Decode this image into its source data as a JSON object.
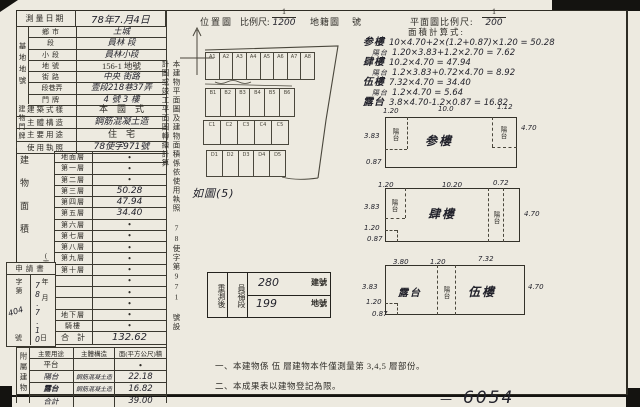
{
  "header": {
    "survey_date_label": "測量日期",
    "survey_date_value": "78年7.月4日",
    "location_map_label": "位置圖",
    "scale_label": "比例尺:",
    "scale_num": "1",
    "scale_den": "1200",
    "cadastral_map_label": "地籍圖",
    "sheet_no_label": "號",
    "plan_scale_label": "平面圖比例尺:",
    "plan_scale_num": "1",
    "plan_scale_den": "200"
  },
  "site": {
    "spine": "基地地號",
    "rows": [
      {
        "label": "鄉市",
        "value": "土城",
        "hw": true
      },
      {
        "label": "段",
        "value": "員林 段",
        "hw": true
      },
      {
        "label": "小段",
        "value": "員林小段",
        "hw": true
      },
      {
        "label": "地號",
        "value": "156-1 地號",
        "hw": false
      }
    ],
    "door_spine": "建物門牌",
    "door_rows": [
      {
        "label": "街路",
        "value": "中央 街路",
        "hw": true
      },
      {
        "label": "段巷弄",
        "value": "壹段218巷37弄",
        "hw": true
      },
      {
        "label": "門牌",
        "value": "4 號 3 樓",
        "hw": true
      }
    ]
  },
  "building": {
    "style_label": "建築式樣",
    "style_value": "本　國　式",
    "structure_label": "主體構造",
    "structure_value": "鋼筋混凝土造",
    "use_label": "主要用途",
    "use_value": "住　宅",
    "license_label": "使用執照",
    "license_value": "78使字971號"
  },
  "area_table": {
    "spine": "建物面積",
    "spine_unit": "(平方公尺)",
    "rows": [
      {
        "label": "地面層",
        "value": "•"
      },
      {
        "label": "第一層",
        "value": "•"
      },
      {
        "label": "第二層",
        "value": "•"
      },
      {
        "label": "第三層",
        "value": "50.28"
      },
      {
        "label": "第四層",
        "value": "47.94"
      },
      {
        "label": "第五層",
        "value": "34.40"
      },
      {
        "label": "第六層",
        "value": "•"
      },
      {
        "label": "第七層",
        "value": "•"
      },
      {
        "label": "第八層",
        "value": "•"
      },
      {
        "label": "第九層",
        "value": "•"
      },
      {
        "label": "第十層",
        "value": "•"
      },
      {
        "label": "",
        "value": "•"
      },
      {
        "label": "",
        "value": "•"
      },
      {
        "label": "",
        "value": "•"
      },
      {
        "label": "地下層",
        "value": "•"
      },
      {
        "label": "騎樓",
        "value": "•"
      }
    ],
    "total_label": "合　計",
    "total_value": "132.62"
  },
  "application": {
    "title": "申請書",
    "no_label_top": "字第",
    "no_value": "404",
    "no_label_bottom": "號",
    "date_chars": "年月",
    "date_value": "78.7.10",
    "date_label_bottom": "日"
  },
  "annex": {
    "spine": "附屬建物",
    "headers": [
      "主要用途",
      "主體構造",
      "面(平方公尺)積"
    ],
    "rows": [
      {
        "use": "平台",
        "structure": "",
        "area": "•",
        "hw": false
      },
      {
        "use": "陽台",
        "structure": "鋼筋混凝土造",
        "area": "22.18",
        "hw": true
      },
      {
        "use": "露台",
        "structure": "鋼筋混凝土造",
        "area": "16.82",
        "hw": true
      },
      {
        "use": "合計",
        "structure": "",
        "area": "39.00",
        "hw": true
      }
    ]
  },
  "middle": {
    "vertical_note": "本建物平面圖及建物面積係依使用執照 78使字第971 號設計圖或竣工平面圖轉繪計算",
    "map_caption": "如圖(5)",
    "parcels": [
      [
        "A1",
        "A2",
        "A3",
        "A4",
        "A5",
        "A6",
        "A7",
        "A8"
      ],
      [
        "B1",
        "B2",
        "B3",
        "B4",
        "B5",
        "B6"
      ],
      [
        "C1",
        "C2",
        "C3",
        "C4",
        "C5"
      ],
      [
        "D1",
        "D2",
        "D3",
        "D4",
        "D5"
      ]
    ],
    "resurvey": {
      "left_label": "重測後",
      "section": "員福段",
      "building_no": "280",
      "building_no_label": "建號",
      "land_no": "199",
      "land_no_label": "地號"
    },
    "notes": [
      "一、本建物係 伍 層建物本件僅測量第 3,4,5 層部份。",
      "二、本成果表以建物登記為限。"
    ]
  },
  "calc": {
    "title": "面積計算式:",
    "lines": [
      {
        "name": "参樓",
        "small": false,
        "expr": "10×4.70+2×(1.2+0.87)×1.20 = 50.28"
      },
      {
        "name": "陽台",
        "small": true,
        "expr": "1.20×3.83+1.2×2.70 = 7.62"
      },
      {
        "name": "肆樓",
        "small": false,
        "expr": "10.2×4.70 = 47.94"
      },
      {
        "name": "陽台",
        "small": true,
        "expr": "1.2×3.83+0.72×4.70 = 8.92"
      },
      {
        "name": "伍樓",
        "small": false,
        "expr": "7.32×4.70 = 34.40"
      },
      {
        "name": "陽台",
        "small": true,
        "expr": "1.2×4.70 = 5.64"
      },
      {
        "name": "露台",
        "small": false,
        "expr": "3.8×4.70-1.2×0.87 = 16.82"
      }
    ]
  },
  "plans": [
    {
      "name": "参樓",
      "left_balcony": "陽台",
      "right_balcony": "陽台",
      "dim_top_left": "1.20",
      "dim_top": "10.0",
      "dim_top_right": "1.12",
      "dim_right": "4.70",
      "dim_left": "3.83",
      "dim_left_lower": "0.87"
    },
    {
      "name": "肆樓",
      "left_balcony": "陽台",
      "right_balcony": "陽台",
      "dim_top_left": "1.20",
      "dim_top": "10.20",
      "dim_top_right": "0.72",
      "dim_right": "4.70",
      "dim_left": "3.83",
      "dim_notch_w": "1.20",
      "dim_notch_h": "0.87"
    },
    {
      "name": "伍樓",
      "terrace": "露台",
      "balcony": "陽台",
      "dim_top_left": "3.80",
      "dim_top_mid": "1.20",
      "dim_top_right": "7.32",
      "dim_right": "4.70",
      "dim_left": "3.83",
      "dim_notch_w": "1.20",
      "dim_notch_h": "0.87"
    }
  ],
  "page_number": "6054",
  "colors": {
    "paper": "#edeae0",
    "ink": "#2f2d28",
    "hand": "#23232c"
  }
}
